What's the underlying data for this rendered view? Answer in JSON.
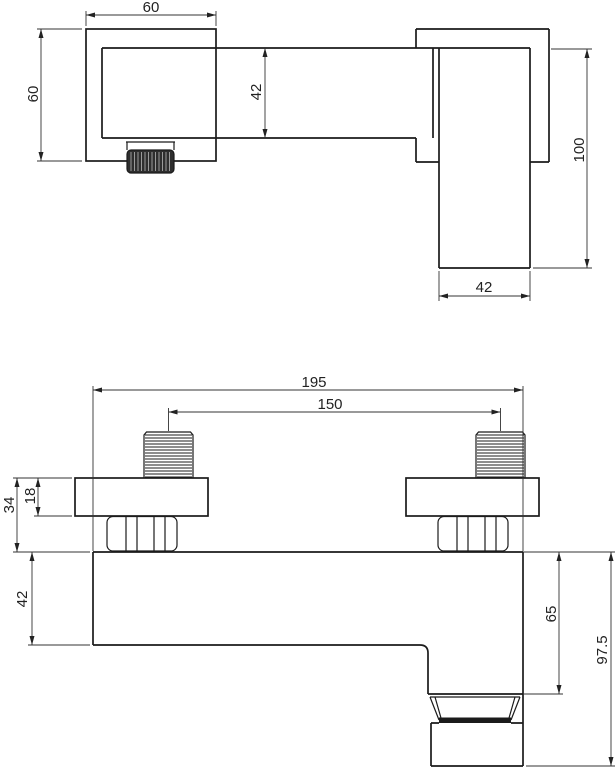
{
  "colors": {
    "line": "#1b1b1b",
    "dim_line": "#333333",
    "text": "#222222",
    "background": "#ffffff"
  },
  "side_view": {
    "plate_width": "60",
    "plate_height": "60",
    "body_height": "42",
    "handle_length": "100",
    "handle_width": "42"
  },
  "front_view": {
    "overall_width": "195",
    "inlet_spacing": "150",
    "plate_nut_depth": "34",
    "plate_depth": "18",
    "body_height": "42",
    "body_to_aerator": "65",
    "body_to_spout_end": "97.5"
  }
}
